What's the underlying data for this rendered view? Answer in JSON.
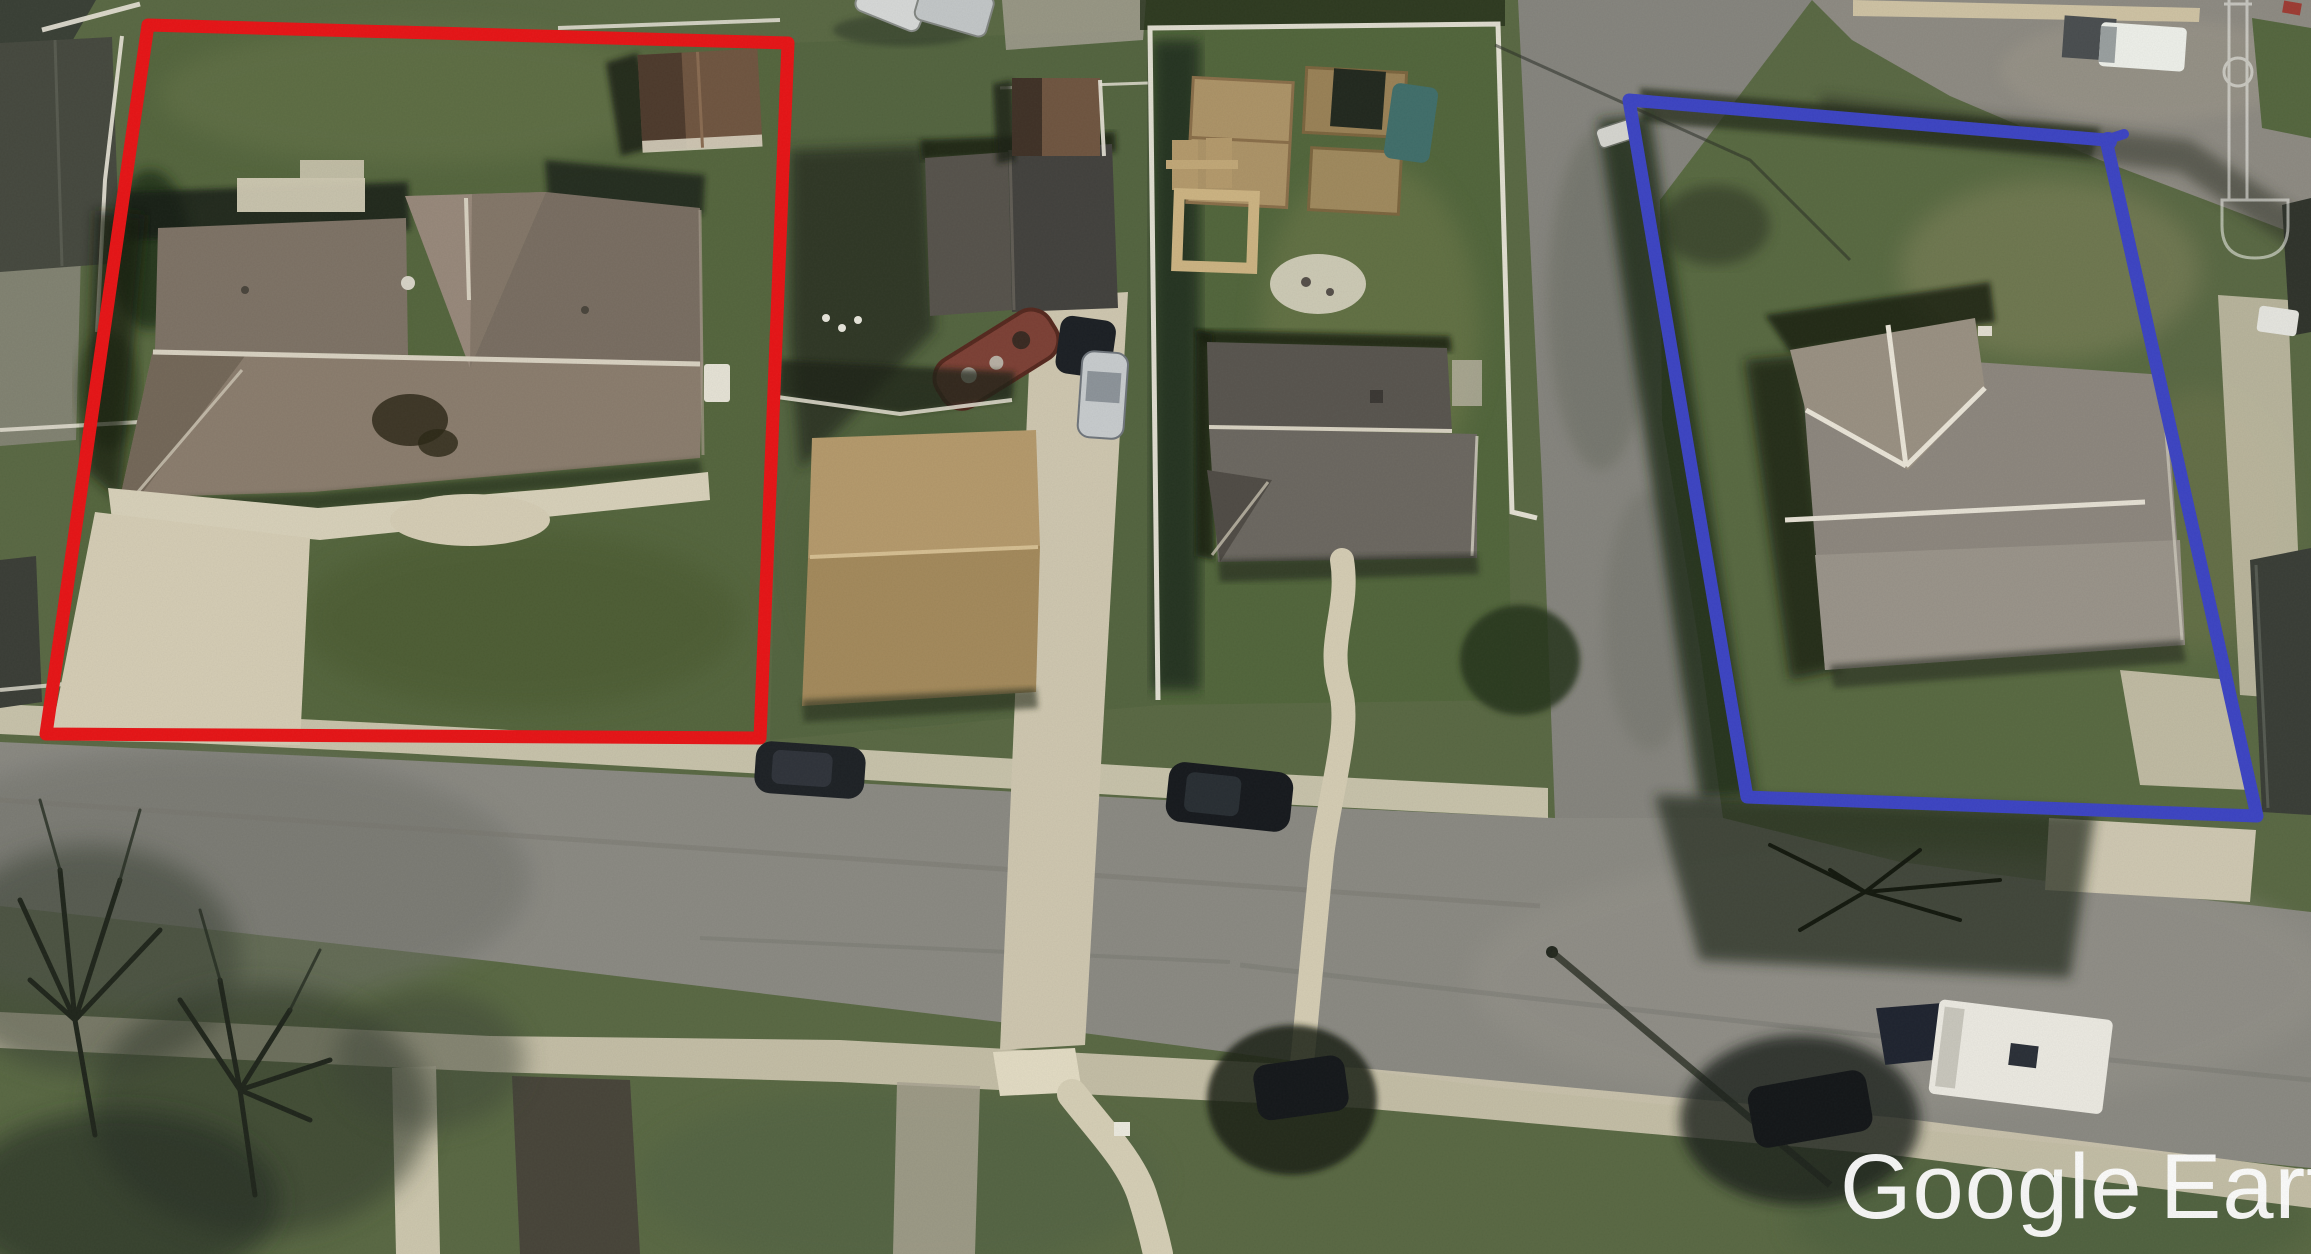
{
  "app": {
    "name": "Google Earth"
  },
  "watermark": {
    "brand": "Google",
    "product": "Earth",
    "color": "#ffffff"
  },
  "annotations": {
    "red_box": {
      "color": "#e81517",
      "shape": "quadrilateral",
      "meaning": "left highlighted lot"
    },
    "blue_box": {
      "color": "#3d45c4",
      "shape": "quadrilateral",
      "meaning": "right highlighted lot"
    }
  },
  "icons": {
    "street_lamp": "lamp-post-outline-icon"
  },
  "palette": {
    "grass": "#5a6944",
    "grass_dark": "#3f5132",
    "road": "#8b8a83",
    "concrete": "#cfc8b1",
    "roof_gray_brown": "#8b7d6e",
    "roof_dark": "#43423e",
    "roof_tan": "#b59a6c",
    "shadow": "#1c2317"
  }
}
